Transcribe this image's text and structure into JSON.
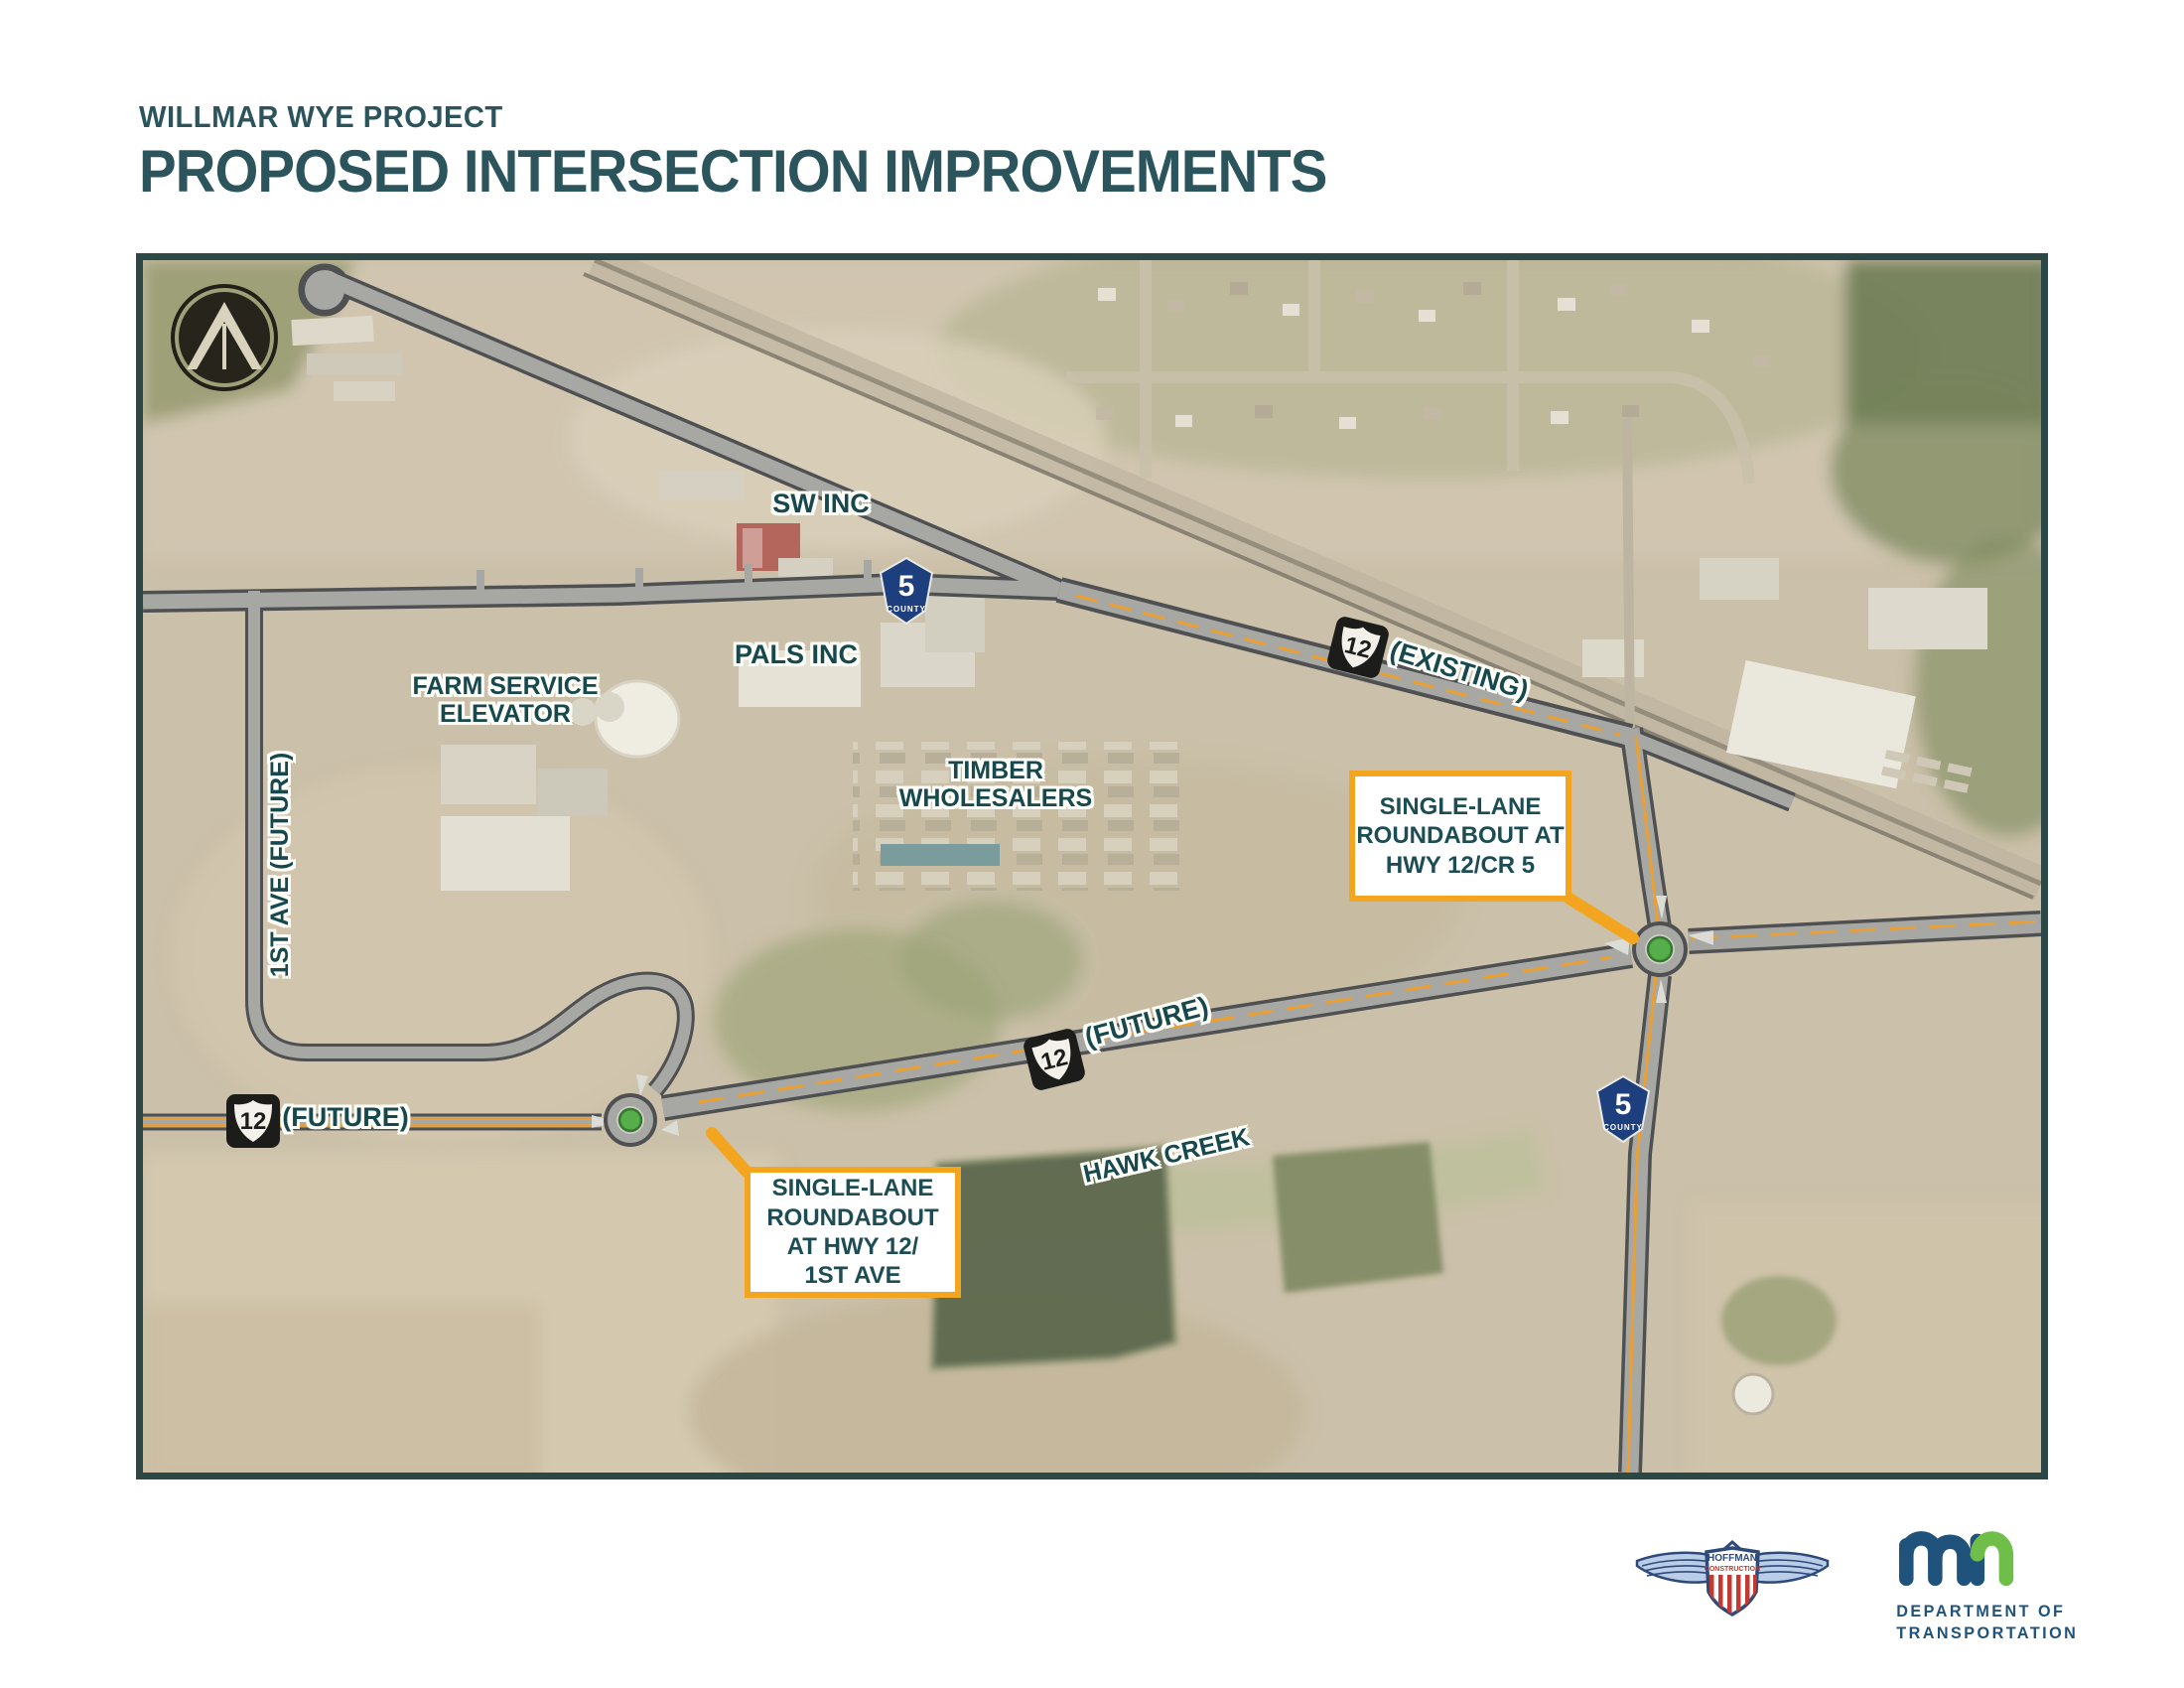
{
  "title": {
    "kicker": "WILLMAR WYE PROJECT",
    "heading": "PROPOSED INTERSECTION IMPROVEMENTS"
  },
  "map": {
    "labels": {
      "sw_inc": "SW INC",
      "pals_inc": "PALS INC",
      "farm_service": "FARM SERVICE\nELEVATOR",
      "timber": "TIMBER\nWHOLESALERS",
      "hawk_creek": "HAWK CREEK",
      "existing": "(EXISTING)",
      "future_diag": "(FUTURE)",
      "future_west": "(FUTURE)",
      "first_ave": "1ST AVE (FUTURE)"
    },
    "shields": {
      "us12": "12",
      "county5": "5",
      "county_word": "COUNTY"
    },
    "callouts": {
      "cr5": "SINGLE-LANE\nROUNDABOUT AT\nHWY 12/CR 5",
      "first_ave": "SINGLE-LANE\nROUNDABOUT\nAT HWY 12/\n1ST AVE"
    },
    "icons": {
      "north_arrow": "compass-north-arrow"
    },
    "colors": {
      "accent_orange": "#F3A51F",
      "label_teal": "#16484E",
      "county_blue": "#1E3F7E",
      "roundabout_green": "#55AE49",
      "map_border": "#2C4846"
    }
  },
  "footer": {
    "hoffman": {
      "line1": "HOFFMAN",
      "line2": "CONSTRUCTION"
    },
    "mndot": {
      "dept_line1": "DEPARTMENT OF",
      "dept_line2": "TRANSPORTATION"
    }
  }
}
